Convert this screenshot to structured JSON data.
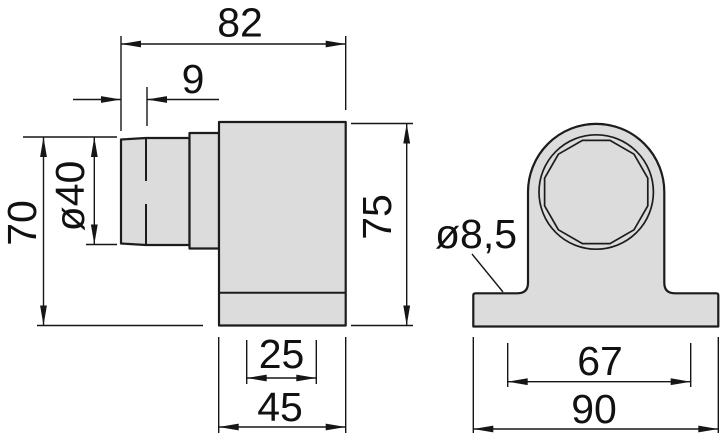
{
  "drawing": {
    "kind": "technical dimension drawing",
    "views": [
      "side view",
      "front view"
    ]
  },
  "dims": {
    "total_length": "82",
    "tip_length": "9",
    "spigot_diameter": "ø40",
    "overall_height": "70",
    "body_height": "75",
    "cable_entry_width": "25",
    "body_width": "45",
    "mounting_hole_diameter": "ø8,5",
    "hole_spacing": "67",
    "base_width": "90"
  },
  "colors": {
    "part_fill": "#dcdcdc",
    "outline": "#1c1c1c",
    "dimension_line": "#161616",
    "background": "#ffffff"
  }
}
